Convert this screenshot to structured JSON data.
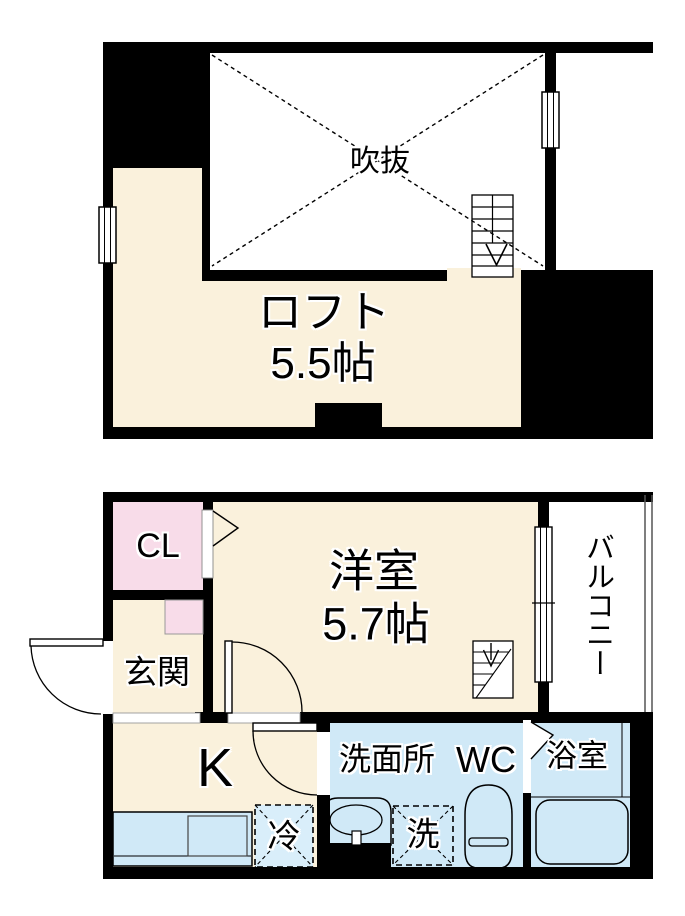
{
  "plan": {
    "title_context": "two-storey apartment floor plan",
    "colors": {
      "wall": "#000000",
      "room_floor": "#FAF1DC",
      "closet_pink": "#F8DCE9",
      "water_blue": "#D0E9F7",
      "background": "#FFFFFF"
    },
    "upper_floor": {
      "void_label": "吹抜",
      "loft_label": "ロフト",
      "loft_size": "5.5帖"
    },
    "lower_floor": {
      "closet_label": "CL",
      "entrance_label": "玄関",
      "room_label": "洋室",
      "room_size": "5.7帖",
      "balcony_label": "バルコニー",
      "kitchen_label": "K",
      "washroom_label": "洗面所",
      "toilet_label": "WC",
      "bath_label": "浴室",
      "washer_label": "洗",
      "fridge_label": "冷"
    }
  }
}
